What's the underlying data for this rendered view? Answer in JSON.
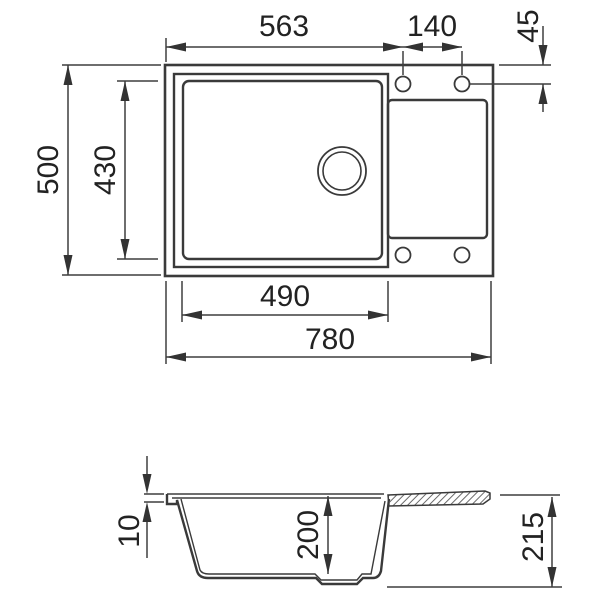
{
  "drawing": {
    "type": "sink-technical-drawing",
    "views": {
      "top_view": {
        "dim_left_to_hole": "563",
        "dim_hole_spacing": "140",
        "dim_hole_edge_offset": "45",
        "dim_overall_depth": "500",
        "dim_bowl_depth": "430",
        "dim_bowl_width": "490",
        "dim_overall_width": "780"
      },
      "side_view": {
        "dim_rim_height": "10",
        "dim_bowl_inner_depth": "200",
        "dim_overall_height": "215"
      }
    },
    "colors": {
      "line": "#3a3a3a",
      "text": "#222222",
      "background": "#ffffff"
    }
  }
}
